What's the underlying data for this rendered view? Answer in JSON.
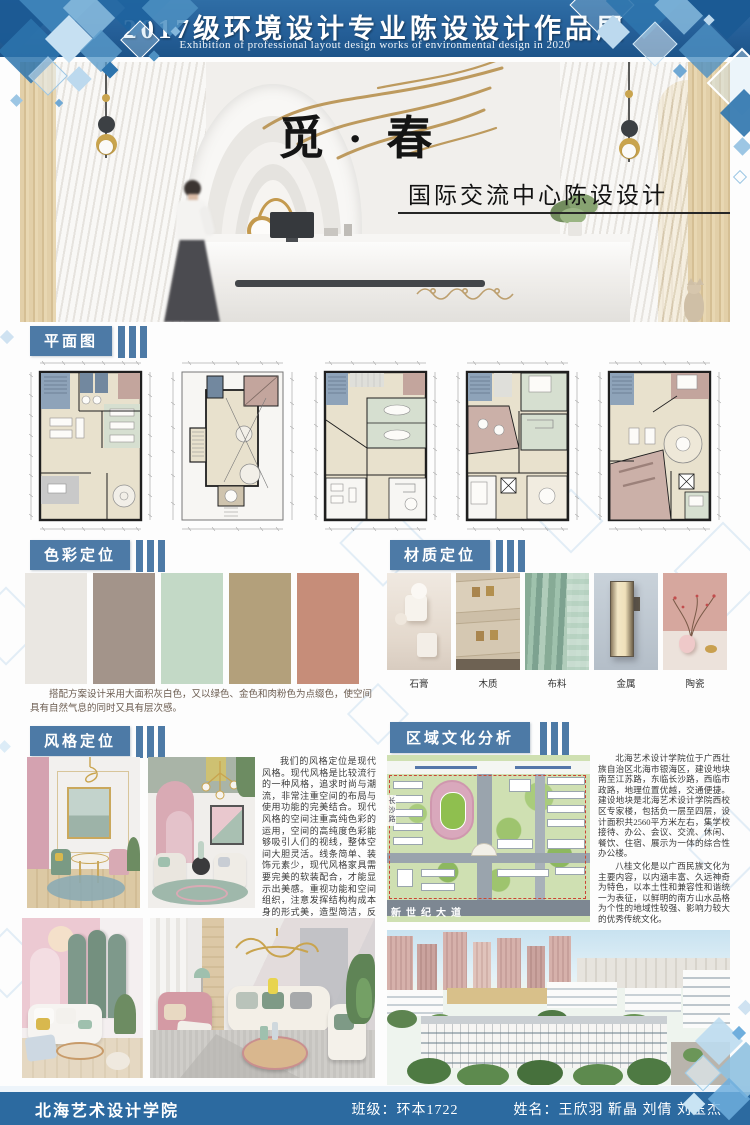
{
  "header": {
    "title": "2017级环境设计专业陈设设计作品展",
    "subtitle": "Exhibition of professional layout design works of environmental design in 2020"
  },
  "hero": {
    "title": "觅 · 春",
    "subtitle": "国际交流中心陈设设计"
  },
  "sections": {
    "plan": "平面图",
    "color": "色彩定位",
    "material": "材质定位",
    "style": "风格定位",
    "culture": "区域文化分析"
  },
  "color_section": {
    "swatches": [
      "#EAE7E2",
      "#A3948A",
      "#C3D9C6",
      "#B3A07B",
      "#C68D79"
    ],
    "caption": "搭配方案设计采用大面积灰白色，又以绿色、金色和肉粉色为点缀色，使空间具有自然气息的同时又具有层次感。"
  },
  "material_section": {
    "items": [
      {
        "label": "石膏"
      },
      {
        "label": "木质"
      },
      {
        "label": "布料"
      },
      {
        "label": "金属"
      },
      {
        "label": "陶瓷"
      }
    ]
  },
  "style_section": {
    "text": "我们的风格定位是现代风格。现代风格是比较流行的一种风格，追求时尚与潮流，非常注重空间的布局与使用功能的完美结合。现代风格的空间注重高纯色彩的运用，空间的高纯度色彩能够吸引人们的视线，整体空间大胆灵活。线条简单、装饰元素少，现代风格家具需要完美的软装配合，才能显示出美感。重视功能和空间组织，注意发挥结构构成本身的形式美，造型简洁，反对多余装饰。"
  },
  "culture_section": {
    "para1": "北海艺术设计学院位于广西壮族自治区北海市银海区，建设地块南至江苏路，东临长沙路，西临市政路，地理位置优越，交通便捷。建设地块是北海艺术设计学院西校区专家楼，包括负一层至四层，设计面积共2560平方米左右，集学校接待、办公、会议、交流、休闲、餐饮、住宿、展示为一体的综合性办公楼。",
    "para2": "八桂文化是以广西民族文化为主要内容，以内涵丰富、久远神奇为特色，以本土性和兼容性和谐统一为表征，以鲜明的南方山水品格为个性的地域性较强、影响力较大的优秀传统文化。",
    "map": {
      "road_label": "新世纪大道",
      "side_label": "长沙路"
    }
  },
  "footer": {
    "school": "北海艺术设计学院",
    "class_label": "班级：环本1722",
    "names_label": "姓名：王欣羽 靳晶 刘倩 刘玉杰"
  },
  "colors": {
    "banner_blue": "#28649C",
    "section_blue": "#4D7AA6",
    "footer_blue": "#2C6AA0"
  }
}
